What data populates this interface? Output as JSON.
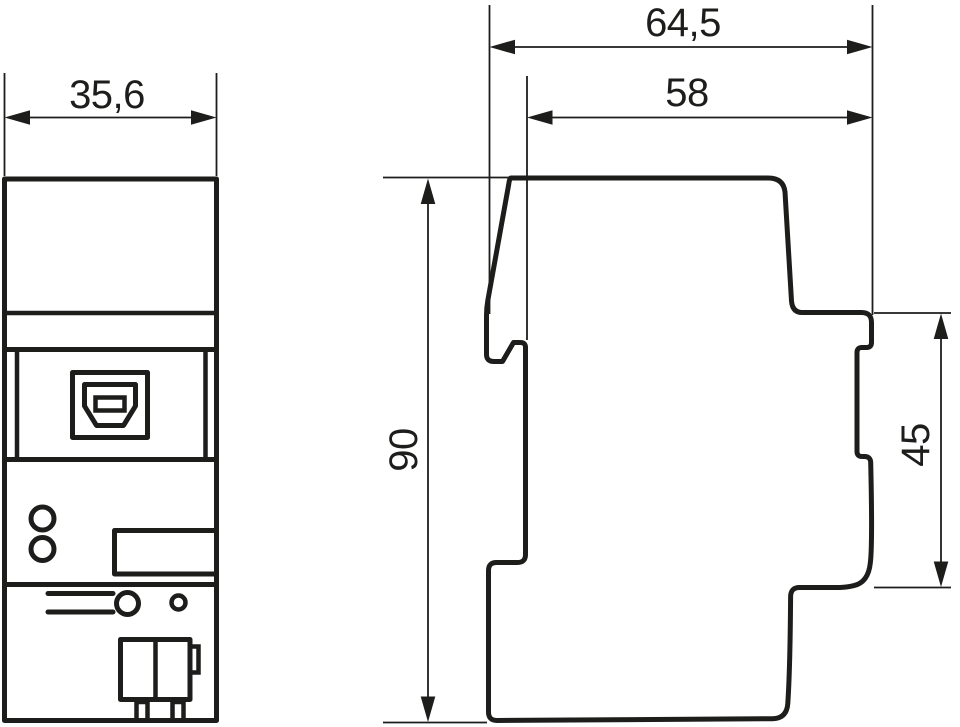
{
  "drawing": {
    "kind": "technical-dimension-drawing",
    "colors": {
      "line": "#1d1d1b",
      "background": "#ffffff"
    },
    "front_view": {
      "width_dim": "35,6",
      "feature_icons": [
        "usb-b-port-icon",
        "led-indicator-icon",
        "label-field",
        "release-lever-icon",
        "programming-button-icon",
        "bus-terminal-icon"
      ]
    },
    "side_view": {
      "total_depth_dim": "64,5",
      "body_depth_dim": "58",
      "height_dim": "90",
      "din_section_height_dim": "45"
    }
  }
}
